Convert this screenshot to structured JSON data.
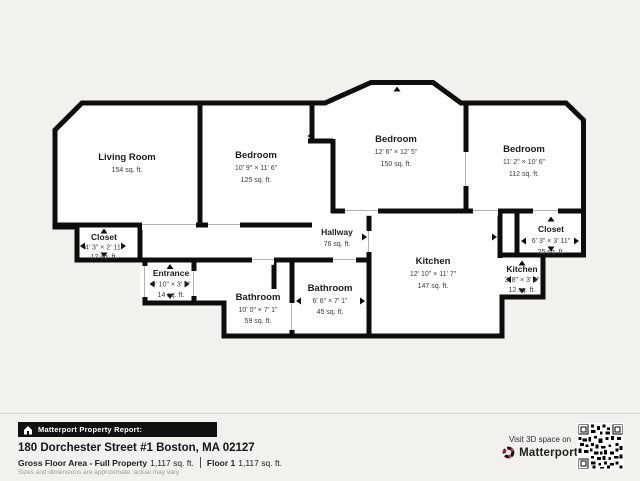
{
  "colors": {
    "background": "#f2f1ee",
    "wall": "#0d0d0d",
    "bar_bg": "#101010",
    "accent_red": "#e0103a"
  },
  "icons": {
    "report_house": "⌂",
    "matterport_logo": "◔",
    "qr_code": "▦",
    "measure_arrow": "▲"
  },
  "floorplan": {
    "rooms": [
      {
        "id": "living-room",
        "name": "Living Room",
        "area": "154 sq. ft."
      },
      {
        "id": "bedroom-1",
        "name": "Bedroom",
        "dims": "10' 9\" × 11' 6\"",
        "area": "125 sq. ft."
      },
      {
        "id": "bedroom-2",
        "name": "Bedroom",
        "dims": "12' 6\" × 12' 5\"",
        "area": "150 sq. ft."
      },
      {
        "id": "bedroom-3",
        "name": "Bedroom",
        "dims": "11' 2\" × 10' 6\"",
        "area": "112 sq. ft."
      },
      {
        "id": "closet-left",
        "name": "Closet",
        "dims": "4' 3\" × 2' 11\"",
        "area": "12 sq. ft."
      },
      {
        "id": "closet-right",
        "name": "Closet",
        "dims": "6' 3\" × 3' 11\"",
        "area": "25 sq. ft."
      },
      {
        "id": "hallway",
        "name": "Hallway",
        "area": "76 sq. ft."
      },
      {
        "id": "kitchen",
        "name": "Kitchen",
        "dims": "12' 10\" × 11' 7\"",
        "area": "147 sq. ft."
      },
      {
        "id": "kitchen-small",
        "name": "Kitchen",
        "dims": "3' 8\" × 3' 4\"",
        "area": "12 sq. ft."
      },
      {
        "id": "entrance",
        "name": "Entrance",
        "dims": "9' 10\" × 3' 8\"",
        "area": "14 sq. ft."
      },
      {
        "id": "bathroom-large",
        "name": "Bathroom",
        "dims": "10' 0\" × 7' 1\"",
        "area": "59 sq. ft."
      },
      {
        "id": "bathroom-small",
        "name": "Bathroom",
        "dims": "6' 6\" × 7' 1\"",
        "area": "45 sq. ft."
      }
    ]
  },
  "footer": {
    "report_bar": "Matterport Property Report:",
    "address": "180 Dorchester Street #1 Boston, MA 02127",
    "gfa_label": "Gross Floor Area - Full Property",
    "gfa_value": "1,117 sq. ft.",
    "floor_label": "Floor 1",
    "floor_value": "1,117 sq. ft.",
    "disclaimer": "Sizes and dimensions are approximate, actual may vary",
    "visit_text": "Visit 3D space on",
    "brand": "Matterport"
  }
}
